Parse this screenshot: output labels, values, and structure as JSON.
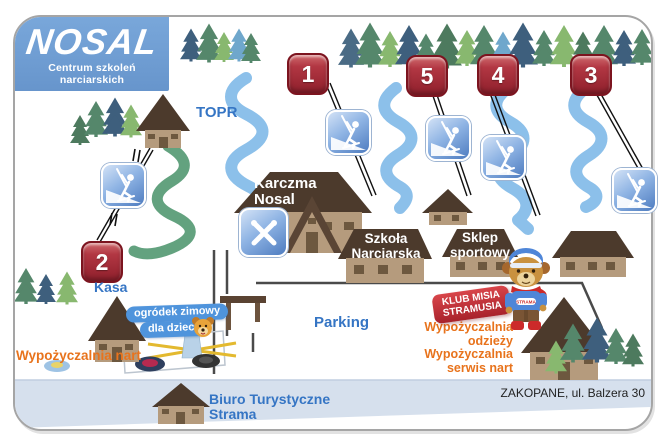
{
  "logo": {
    "title": "NOSAL",
    "subtitle": "Centrum szkoleń narciarskich"
  },
  "markers": [
    {
      "number": "1"
    },
    {
      "number": "2"
    },
    {
      "number": "3"
    },
    {
      "number": "4"
    },
    {
      "number": "5"
    }
  ],
  "places": {
    "topr": "TOPR",
    "kasa": "Kasa",
    "parking": "Parking"
  },
  "buildings": {
    "karczma": {
      "line1": "Karczma",
      "line2": "Nosal"
    },
    "szkola": {
      "line1": "Szkoła",
      "line2": "Narciarska"
    },
    "sklep": {
      "line1": "Sklep",
      "line2": "sportowy"
    },
    "biuro": {
      "line1": "Biuro Turystyczne",
      "line2": "Strama"
    }
  },
  "rentals": {
    "nart": "Wypożyczalnia nart",
    "odziez": {
      "line1": "Wypożyczalnia",
      "line2": "odzieży"
    },
    "serwis": {
      "line1": "Wypożyczalnia",
      "line2": "serwis nart"
    }
  },
  "kids_area": {
    "line1": "ogródek zimowy",
    "line2": "dla dzieci"
  },
  "klub": {
    "line1": "KLUB MISIA",
    "line2": "STRAMUSIA"
  },
  "mascot": {
    "shirt": "STRAMA"
  },
  "address": "ZAKOPANE, ul. Balzera 30",
  "icons": {
    "lift": "surface-lift-icon",
    "restaurant": "restaurant-icon",
    "bear_face": "bear-face-icon",
    "mascot": "teddy-bear-mascot"
  },
  "colors": {
    "logo_blue": "#6d9cd2",
    "marker_red": "#a32433",
    "slope_blue": "#8cc0ea",
    "slope_green": "#63a27f",
    "label_blue": "#3575c4",
    "label_orange": "#e8731c",
    "road_gray_blue": "#d6e0ed",
    "roof_brown": "#4c3a2c",
    "wall_tan": "#b59b7d"
  }
}
